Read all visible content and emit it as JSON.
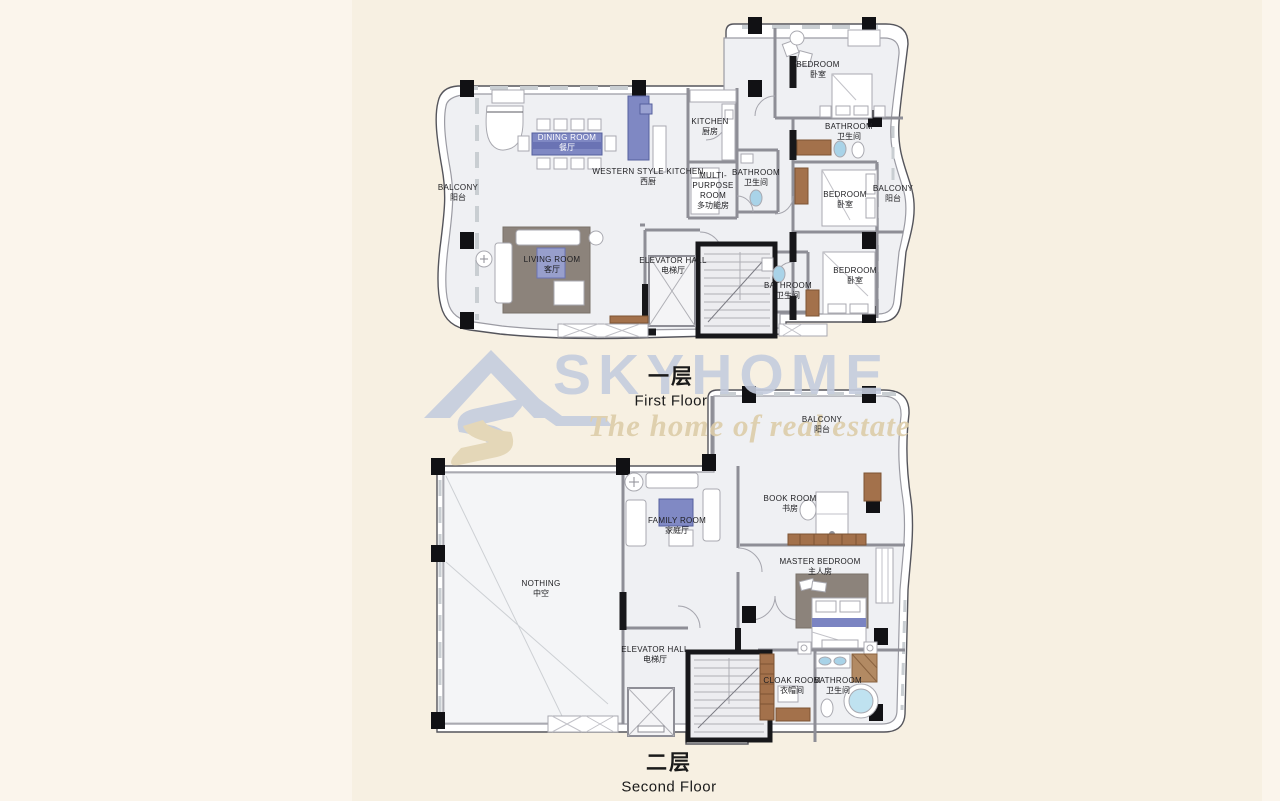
{
  "watermark": {
    "brand": "SKYHOME",
    "tagline": "The home of real estate",
    "logo_icon": "house-roof-s-logo"
  },
  "floors": {
    "first": {
      "title_zh": "一层",
      "title_en": "First Floor",
      "rooms": [
        {
          "en": "BALCONY",
          "zh": "阳台"
        },
        {
          "en": "DINING ROOM",
          "zh": "餐厅"
        },
        {
          "en": "WESTERN STYLE KITCHEN",
          "zh": "西厨"
        },
        {
          "en": "KITCHEN",
          "zh": "厨房"
        },
        {
          "en": "MULTI-PURPOSE ROOM",
          "zh": "多功能房"
        },
        {
          "en": "BATHROOM",
          "zh": "卫生间"
        },
        {
          "en": "LIVING ROOM",
          "zh": "客厅"
        },
        {
          "en": "ELEVATOR HALL",
          "zh": "电梯厅"
        },
        {
          "en": "BATHROOM",
          "zh": "卫生间"
        },
        {
          "en": "BEDROOM",
          "zh": "卧室"
        },
        {
          "en": "BATHROOM",
          "zh": "卫生间"
        },
        {
          "en": "BEDROOM",
          "zh": "卧室"
        },
        {
          "en": "BALCONY",
          "zh": "阳台"
        },
        {
          "en": "BEDROOM",
          "zh": "卧室"
        }
      ]
    },
    "second": {
      "title_zh": "二层",
      "title_en": "Second Floor",
      "rooms": [
        {
          "en": "BALCONY",
          "zh": "阳台"
        },
        {
          "en": "FAMILY ROOM",
          "zh": "家庭厅"
        },
        {
          "en": "BOOK ROOM",
          "zh": "书房"
        },
        {
          "en": "MASTER BEDROOM",
          "zh": "主人房"
        },
        {
          "en": "NOTHING",
          "zh": "中空"
        },
        {
          "en": "ELEVATOR HALL",
          "zh": "电梯厅"
        },
        {
          "en": "CLOAK ROOM",
          "zh": "衣帽间"
        },
        {
          "en": "BATHROOM",
          "zh": "卫生间"
        }
      ]
    }
  },
  "colors": {
    "brand_color": "#c5cdde",
    "tagline_color": "#ddcda9",
    "bg_base": "#f7f0e2",
    "bg_side": "#fbf5ec",
    "floor_fill": "#eff0f3",
    "accent_blue": "#7f88c3",
    "accent_blue_light": "#989fcc",
    "wood_brown": "#a3714b",
    "tub_blue": "#b5d9ec",
    "wall_gray": "#8e8e96",
    "wall_dark": "#17171a"
  }
}
